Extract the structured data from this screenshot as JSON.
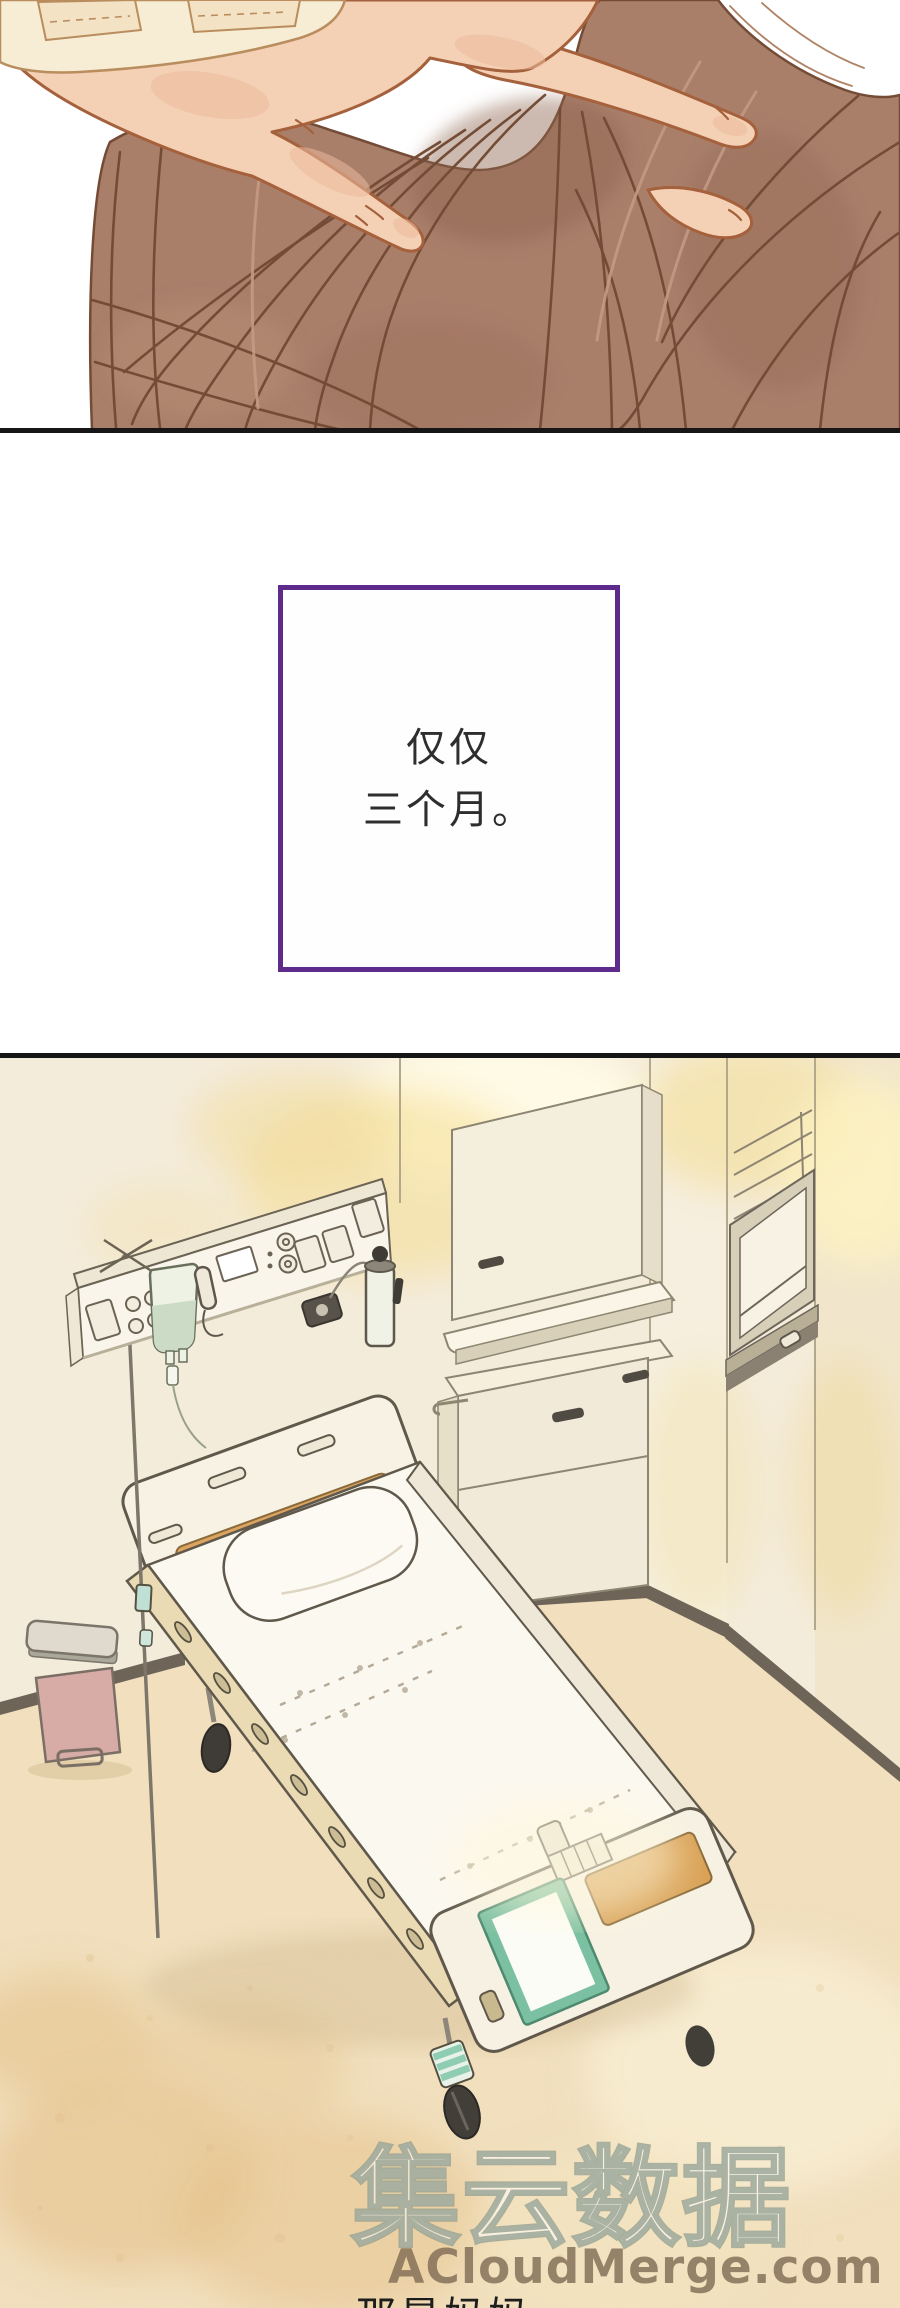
{
  "page": {
    "width": 900,
    "height": 2308,
    "background_color": "#ffffff"
  },
  "dividers": {
    "color": "#161616"
  },
  "top_panel": {
    "scene": "a hand gently resting on a person's brown hair",
    "colors": {
      "skin": "#f4d0b5",
      "skin_outline": "#a5603c",
      "hair_base": "#a97f6a",
      "hair_strand": "#744c36",
      "sleeve": "#f7ecd4"
    }
  },
  "narration_box": {
    "lines": [
      "仅仅",
      "三个月。"
    ],
    "border_color": "#5e2b8d",
    "text_color": "#2e2e2e"
  },
  "room_panel": {
    "scene": "empty hospital room with bed, IV pole, headwall unit, cabinets, window and pedal trash can",
    "colors": {
      "wall": "#f4ecdb",
      "floor": "#f1dfbd",
      "baseboard": "#6e6457",
      "bed_frame": "#f6f1e3",
      "headboard_panel": "#dca45f",
      "side_rail": "#eadbb4",
      "whiteboard_frame": "#7cc0a2",
      "iv_bag": "#eef2e4",
      "trash_body": "#d8aca6",
      "trash_lid": "#dfdacd",
      "glow": "#f2d878"
    }
  },
  "watermark": {
    "cjk_text": "集云数据",
    "site_text": "ACloudMerge.com"
  },
  "bottom_caption": {
    "text": "那是妈妈"
  }
}
